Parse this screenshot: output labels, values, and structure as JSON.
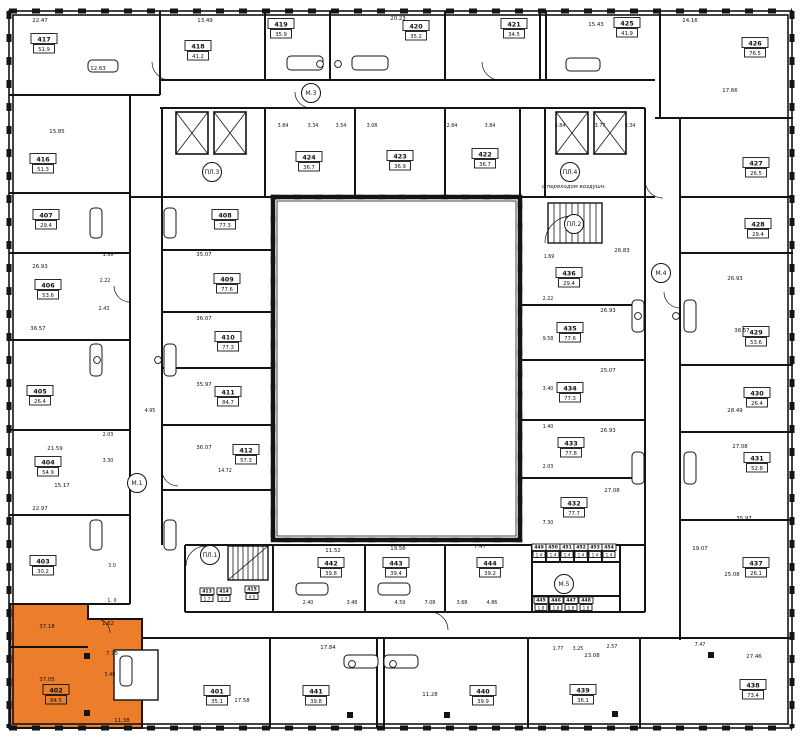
{
  "plan": {
    "width": 800,
    "height": 737,
    "colors": {
      "wall": "#141414",
      "highlight": "#EC7E2B",
      "paper": "#ffffff",
      "dim_text": "#222222"
    },
    "highlighted_unit": "402",
    "units": [
      {
        "n": "417",
        "a": "51.9",
        "x": 44,
        "y": 44
      },
      {
        "n": "418",
        "a": "41.2",
        "x": 198,
        "y": 51
      },
      {
        "n": "419",
        "a": "35.9",
        "x": 281,
        "y": 29
      },
      {
        "n": "420",
        "a": "35.2",
        "x": 416,
        "y": 31
      },
      {
        "n": "421",
        "a": "34.5",
        "x": 514,
        "y": 29
      },
      {
        "n": "425",
        "a": "41.9",
        "x": 627,
        "y": 28
      },
      {
        "n": "426",
        "a": "76.5",
        "x": 755,
        "y": 48
      },
      {
        "n": "416",
        "a": "51.3",
        "x": 43,
        "y": 164
      },
      {
        "n": "407",
        "a": "29.4",
        "x": 46,
        "y": 220
      },
      {
        "n": "406",
        "a": "53.6",
        "x": 48,
        "y": 290
      },
      {
        "n": "405",
        "a": "26.4",
        "x": 40,
        "y": 396
      },
      {
        "n": "404",
        "a": "54.9",
        "x": 48,
        "y": 467
      },
      {
        "n": "403",
        "a": "30.2",
        "x": 43,
        "y": 566
      },
      {
        "n": "402",
        "a": "84.5",
        "x": 56,
        "y": 695,
        "hl": true
      },
      {
        "n": "427",
        "a": "26.5",
        "x": 756,
        "y": 168
      },
      {
        "n": "428",
        "a": "29.4",
        "x": 758,
        "y": 229
      },
      {
        "n": "429",
        "a": "53.6",
        "x": 756,
        "y": 337
      },
      {
        "n": "430",
        "a": "26.4",
        "x": 757,
        "y": 398
      },
      {
        "n": "431",
        "a": "52.8",
        "x": 757,
        "y": 463
      },
      {
        "n": "437",
        "a": "26.1",
        "x": 756,
        "y": 568
      },
      {
        "n": "438",
        "a": "73.4",
        "x": 753,
        "y": 690
      },
      {
        "n": "401",
        "a": "35.1",
        "x": 217,
        "y": 696
      },
      {
        "n": "441",
        "a": "39.8",
        "x": 316,
        "y": 696
      },
      {
        "n": "440",
        "a": "39.9",
        "x": 483,
        "y": 696
      },
      {
        "n": "439",
        "a": "36.1",
        "x": 583,
        "y": 695
      },
      {
        "n": "424",
        "a": "36.7",
        "x": 309,
        "y": 162
      },
      {
        "n": "423",
        "a": "36.9",
        "x": 400,
        "y": 161
      },
      {
        "n": "422",
        "a": "36.7",
        "x": 485,
        "y": 159
      },
      {
        "n": "408",
        "a": "77.3",
        "x": 225,
        "y": 220
      },
      {
        "n": "409",
        "a": "77.6",
        "x": 227,
        "y": 284
      },
      {
        "n": "410",
        "a": "77.3",
        "x": 228,
        "y": 342
      },
      {
        "n": "411",
        "a": "84.7",
        "x": 228,
        "y": 397
      },
      {
        "n": "412",
        "a": "57.3",
        "x": 246,
        "y": 455
      },
      {
        "n": "436",
        "a": "29.4",
        "x": 569,
        "y": 278
      },
      {
        "n": "435",
        "a": "77.6",
        "x": 570,
        "y": 333
      },
      {
        "n": "434",
        "a": "77.3",
        "x": 570,
        "y": 393
      },
      {
        "n": "433",
        "a": "77.8",
        "x": 571,
        "y": 448
      },
      {
        "n": "432",
        "a": "77.7",
        "x": 574,
        "y": 508
      },
      {
        "n": "442",
        "a": "39.8",
        "x": 331,
        "y": 568
      },
      {
        "n": "443",
        "a": "39.4",
        "x": 396,
        "y": 568
      },
      {
        "n": "444",
        "a": "39.2",
        "x": 490,
        "y": 568
      },
      {
        "n": "413",
        "a": "1.7",
        "x": 207,
        "y": 595,
        "sz": "m"
      },
      {
        "n": "414",
        "a": "1.7",
        "x": 224,
        "y": 595,
        "sz": "m"
      },
      {
        "n": "415",
        "a": "4.5",
        "x": 252,
        "y": 593,
        "sz": "m"
      },
      {
        "n": "449",
        "a": "1.4",
        "x": 539,
        "y": 551,
        "sz": "s"
      },
      {
        "n": "450",
        "a": "1.4",
        "x": 553,
        "y": 551,
        "sz": "s"
      },
      {
        "n": "451",
        "a": "1.4",
        "x": 567,
        "y": 551,
        "sz": "s"
      },
      {
        "n": "452",
        "a": "1.4",
        "x": 581,
        "y": 551,
        "sz": "s"
      },
      {
        "n": "453",
        "a": "1.4",
        "x": 595,
        "y": 551,
        "sz": "s"
      },
      {
        "n": "454",
        "a": "1.4",
        "x": 609,
        "y": 551,
        "sz": "s"
      },
      {
        "n": "445",
        "a": "1.8",
        "x": 541,
        "y": 604,
        "sz": "s"
      },
      {
        "n": "446",
        "a": "1.8",
        "x": 556,
        "y": 604,
        "sz": "s"
      },
      {
        "n": "447",
        "a": "1.8",
        "x": 571,
        "y": 604,
        "sz": "s"
      },
      {
        "n": "448",
        "a": "1.8",
        "x": 586,
        "y": 604,
        "sz": "s"
      }
    ],
    "cores": [
      {
        "label": "М.3",
        "x": 311,
        "y": 93
      },
      {
        "label": "М.1",
        "x": 137,
        "y": 483
      },
      {
        "label": "М.4",
        "x": 661,
        "y": 273
      },
      {
        "label": "М.5",
        "x": 564,
        "y": 584
      },
      {
        "label": "ПЛ.1",
        "x": 210,
        "y": 555
      },
      {
        "label": "ПЛ.2",
        "x": 574,
        "y": 224
      },
      {
        "label": "ПЛ.3",
        "x": 212,
        "y": 172
      },
      {
        "label": "ПЛ.4",
        "x": 570,
        "y": 172
      }
    ],
    "core_note": {
      "text": "с переходом воздушн.",
      "x": 574,
      "y": 188
    },
    "room_labels": [
      {
        "t": "22.47",
        "x": 40,
        "y": 22
      },
      {
        "t": "13.49",
        "x": 205,
        "y": 22
      },
      {
        "t": "20.23",
        "x": 398,
        "y": 20
      },
      {
        "t": "24.16",
        "x": 690,
        "y": 22
      },
      {
        "t": "15.43",
        "x": 596,
        "y": 26
      },
      {
        "t": "17.66",
        "x": 730,
        "y": 92
      },
      {
        "t": "12.63",
        "x": 98,
        "y": 70
      },
      {
        "t": "15.85",
        "x": 57,
        "y": 133
      },
      {
        "t": "26.93",
        "x": 40,
        "y": 268
      },
      {
        "t": "36.57",
        "x": 38,
        "y": 330
      },
      {
        "t": "21.59",
        "x": 55,
        "y": 450
      },
      {
        "t": "15.17",
        "x": 62,
        "y": 487
      },
      {
        "t": "22.97",
        "x": 40,
        "y": 510
      },
      {
        "t": "37.18",
        "x": 47,
        "y": 628
      },
      {
        "t": "37.05",
        "x": 47,
        "y": 681
      },
      {
        "t": "1.62",
        "x": 108,
        "y": 625
      },
      {
        "t": "7.75",
        "x": 112,
        "y": 655
      },
      {
        "t": "11.38",
        "x": 122,
        "y": 722
      },
      {
        "t": "35.07",
        "x": 204,
        "y": 256
      },
      {
        "t": "36.07",
        "x": 204,
        "y": 320
      },
      {
        "t": "35.97",
        "x": 204,
        "y": 386
      },
      {
        "t": "36.07",
        "x": 204,
        "y": 449
      },
      {
        "t": "26.93",
        "x": 735,
        "y": 280
      },
      {
        "t": "36.57",
        "x": 742,
        "y": 332
      },
      {
        "t": "28.49",
        "x": 735,
        "y": 412
      },
      {
        "t": "27.08",
        "x": 740,
        "y": 448
      },
      {
        "t": "35.97",
        "x": 744,
        "y": 520
      },
      {
        "t": "25.08",
        "x": 732,
        "y": 576
      },
      {
        "t": "27.46",
        "x": 754,
        "y": 658
      },
      {
        "t": "26.93",
        "x": 608,
        "y": 312
      },
      {
        "t": "25.07",
        "x": 608,
        "y": 372
      },
      {
        "t": "26.93",
        "x": 608,
        "y": 432
      },
      {
        "t": "27.08",
        "x": 612,
        "y": 492
      },
      {
        "t": "26.83",
        "x": 622,
        "y": 252
      },
      {
        "t": "11.52",
        "x": 333,
        "y": 552
      },
      {
        "t": "19.56",
        "x": 398,
        "y": 550
      },
      {
        "t": "19.07",
        "x": 700,
        "y": 550
      },
      {
        "t": "7.47",
        "x": 480,
        "y": 548
      },
      {
        "t": "17.84",
        "x": 328,
        "y": 649
      },
      {
        "t": "11.28",
        "x": 430,
        "y": 696
      },
      {
        "t": "23.08",
        "x": 592,
        "y": 657
      },
      {
        "t": "17.58",
        "x": 242,
        "y": 702
      }
    ],
    "dims": [
      {
        "t": "3.84",
        "x": 283,
        "y": 127
      },
      {
        "t": "3.34",
        "x": 313,
        "y": 127
      },
      {
        "t": "3.54",
        "x": 341,
        "y": 127
      },
      {
        "t": "3.08",
        "x": 372,
        "y": 127
      },
      {
        "t": "2.84",
        "x": 452,
        "y": 127
      },
      {
        "t": "3.84",
        "x": 490,
        "y": 127
      },
      {
        "t": "3.84",
        "x": 560,
        "y": 127
      },
      {
        "t": "3.77",
        "x": 600,
        "y": 127
      },
      {
        "t": "3.34",
        "x": 630,
        "y": 127
      },
      {
        "t": "1.99",
        "x": 108,
        "y": 256
      },
      {
        "t": "2.22",
        "x": 105,
        "y": 282
      },
      {
        "t": "2.43",
        "x": 104,
        "y": 310
      },
      {
        "t": "2.03",
        "x": 108,
        "y": 436
      },
      {
        "t": "3.30",
        "x": 108,
        "y": 462
      },
      {
        "t": "4.95",
        "x": 150,
        "y": 412
      },
      {
        "t": "14.72",
        "x": 225,
        "y": 472
      },
      {
        "t": "3.0",
        "x": 112,
        "y": 567
      },
      {
        "t": "1. 0",
        "x": 112,
        "y": 602
      },
      {
        "t": "1.69",
        "x": 549,
        "y": 258
      },
      {
        "t": "2.22",
        "x": 548,
        "y": 300
      },
      {
        "t": "9.58",
        "x": 548,
        "y": 340
      },
      {
        "t": "3.40",
        "x": 548,
        "y": 390
      },
      {
        "t": "1.40",
        "x": 548,
        "y": 428
      },
      {
        "t": "2.03",
        "x": 548,
        "y": 468
      },
      {
        "t": "7.30",
        "x": 548,
        "y": 524
      },
      {
        "t": "2.40",
        "x": 308,
        "y": 604
      },
      {
        "t": "3.48",
        "x": 352,
        "y": 604
      },
      {
        "t": "4.59",
        "x": 400,
        "y": 604
      },
      {
        "t": "7.08",
        "x": 430,
        "y": 604
      },
      {
        "t": "3.68",
        "x": 462,
        "y": 604
      },
      {
        "t": "4.86",
        "x": 492,
        "y": 604
      },
      {
        "t": "1.77",
        "x": 558,
        "y": 650
      },
      {
        "t": "3.25",
        "x": 578,
        "y": 650
      },
      {
        "t": "2.57",
        "x": 612,
        "y": 648
      },
      {
        "t": "7.47",
        "x": 700,
        "y": 646
      },
      {
        "t": "5.48",
        "x": 110,
        "y": 676
      }
    ]
  },
  "geometry": {
    "outer": {
      "x": 9,
      "y": 11,
      "w": 783,
      "h": 717
    },
    "outer_inner": {
      "x": 13,
      "y": 15,
      "w": 775,
      "h": 709
    },
    "courtyard": {
      "x": 273,
      "y": 197,
      "w": 247,
      "h": 343
    },
    "courtyard_inner": {
      "x": 277,
      "y": 201,
      "w": 239,
      "h": 335
    },
    "h_walls": [
      [
        9,
        95,
        160
      ],
      [
        160,
        80,
        655
      ],
      [
        655,
        118,
        793
      ],
      [
        160,
        108,
        645
      ],
      [
        9,
        193,
        130
      ],
      [
        9,
        253,
        130
      ],
      [
        9,
        340,
        130
      ],
      [
        9,
        430,
        130
      ],
      [
        9,
        515,
        130
      ],
      [
        9,
        604,
        130
      ],
      [
        680,
        197,
        793
      ],
      [
        680,
        253,
        793
      ],
      [
        680,
        365,
        793
      ],
      [
        680,
        432,
        793
      ],
      [
        680,
        520,
        793
      ],
      [
        162,
        250,
        273
      ],
      [
        162,
        312,
        273
      ],
      [
        162,
        368,
        273
      ],
      [
        162,
        425,
        273
      ],
      [
        162,
        490,
        273
      ],
      [
        520,
        305,
        645
      ],
      [
        520,
        360,
        645
      ],
      [
        520,
        420,
        645
      ],
      [
        520,
        478,
        645
      ],
      [
        185,
        545,
        645
      ],
      [
        185,
        612,
        645
      ],
      [
        142,
        638,
        793
      ],
      [
        10,
        647,
        88
      ],
      [
        88,
        619,
        142
      ],
      [
        130,
        197,
        273
      ],
      [
        520,
        197,
        655
      ],
      [
        532,
        562,
        620
      ],
      [
        532,
        596,
        620
      ]
    ],
    "v_walls": [
      [
        130,
        95,
        604
      ],
      [
        162,
        108,
        545
      ],
      [
        645,
        108,
        612
      ],
      [
        680,
        118,
        640
      ],
      [
        160,
        11,
        95
      ],
      [
        265,
        11,
        80
      ],
      [
        330,
        11,
        80
      ],
      [
        445,
        11,
        80
      ],
      [
        540,
        11,
        80
      ],
      [
        546,
        11,
        80
      ],
      [
        660,
        11,
        118
      ],
      [
        265,
        108,
        197
      ],
      [
        355,
        108,
        197
      ],
      [
        445,
        108,
        197
      ],
      [
        545,
        108,
        197
      ],
      [
        520,
        108,
        197
      ],
      [
        185,
        545,
        612
      ],
      [
        273,
        545,
        612
      ],
      [
        365,
        545,
        612
      ],
      [
        445,
        545,
        612
      ],
      [
        532,
        545,
        612
      ],
      [
        620,
        545,
        612
      ],
      [
        142,
        619,
        728
      ],
      [
        88,
        604,
        619
      ],
      [
        270,
        638,
        728
      ],
      [
        377,
        638,
        728
      ],
      [
        384,
        638,
        728
      ],
      [
        528,
        638,
        728
      ],
      [
        640,
        638,
        728
      ],
      [
        546,
        545,
        562
      ],
      [
        560,
        545,
        562
      ],
      [
        574,
        545,
        562
      ],
      [
        588,
        545,
        562
      ],
      [
        602,
        545,
        562
      ],
      [
        549,
        596,
        612
      ],
      [
        566,
        596,
        612
      ],
      [
        583,
        596,
        612
      ]
    ],
    "elevators": [
      [
        176,
        112,
        32,
        42
      ],
      [
        214,
        112,
        32,
        42
      ],
      [
        556,
        112,
        32,
        42
      ],
      [
        594,
        112,
        32,
        42
      ]
    ],
    "stairs": [
      {
        "x": 548,
        "y": 203,
        "w": 54,
        "h": 40,
        "step": 6,
        "diag": false
      },
      {
        "x": 228,
        "y": 546,
        "w": 40,
        "h": 34,
        "step": 5,
        "diag": true
      }
    ],
    "tubs": [
      [
        287,
        56,
        36,
        14
      ],
      [
        352,
        56,
        36,
        14
      ],
      [
        88,
        60,
        30,
        12
      ],
      [
        566,
        58,
        34,
        13
      ],
      [
        90,
        208,
        12,
        30
      ],
      [
        164,
        208,
        12,
        30
      ],
      [
        90,
        344,
        12,
        32
      ],
      [
        164,
        344,
        12,
        32
      ],
      [
        90,
        520,
        12,
        30
      ],
      [
        164,
        520,
        12,
        30
      ],
      [
        632,
        300,
        12,
        32
      ],
      [
        684,
        300,
        12,
        32
      ],
      [
        632,
        452,
        12,
        32
      ],
      [
        684,
        452,
        12,
        32
      ],
      [
        296,
        583,
        32,
        12
      ],
      [
        378,
        583,
        32,
        12
      ],
      [
        344,
        655,
        34,
        13
      ],
      [
        384,
        655,
        34,
        13
      ],
      [
        120,
        656,
        12,
        30
      ]
    ],
    "sinks": [
      [
        320,
        64
      ],
      [
        338,
        64
      ],
      [
        97,
        360
      ],
      [
        158,
        360
      ],
      [
        638,
        316
      ],
      [
        676,
        316
      ],
      [
        352,
        664
      ],
      [
        393,
        664
      ]
    ],
    "squares": [
      [
        84,
        653
      ],
      [
        84,
        710
      ],
      [
        347,
        712
      ],
      [
        444,
        712
      ],
      [
        612,
        711
      ],
      [
        708,
        652
      ]
    ],
    "white_rects": [
      [
        114,
        650,
        44,
        50
      ]
    ],
    "arcs": [
      "M170,80 A18 18 0 0 1 152,62",
      "M500,80 A18 18 0 0 1 482,62",
      "M545,243 A27 27 0 0 1 572,216",
      "M186,566 A20 20 0 0 1 206,546",
      "M130,302 A16 16 0 0 1 114,286",
      "M680,308 A16 16 0 0 1 664,292",
      "M162,470 A16 16 0 0 0 178,486",
      "M430,612 A18 18 0 0 1 448,630",
      "M96,619 A14 14 0 0 1 110,633",
      "M311,108 A16 16 0 0 1 295,92",
      "M645,180 A18 18 0 0 0 663,198"
    ],
    "highlight_poly": "M10,604 L88,604 L88,619 L142,619 L142,728 L10,728 Z"
  }
}
